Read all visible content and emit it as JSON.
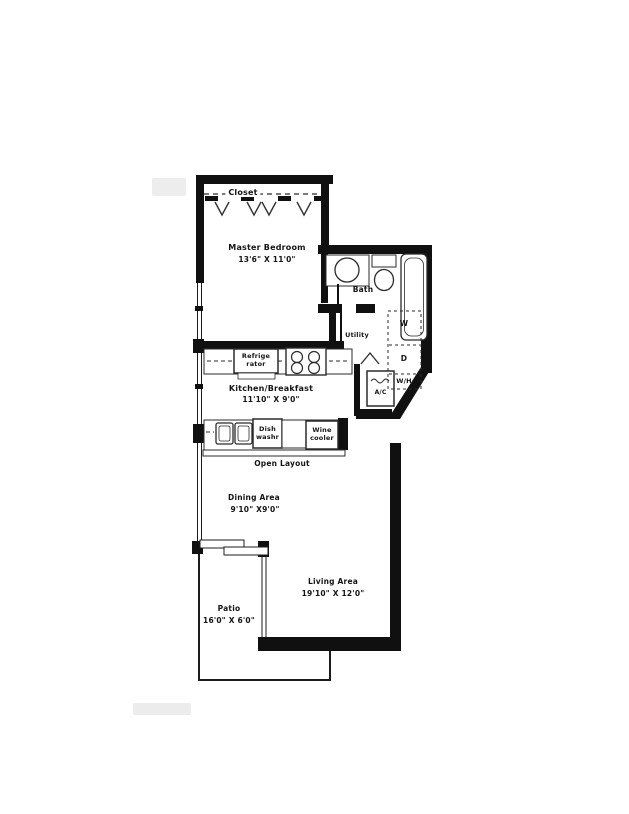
{
  "rooms": {
    "closet": {
      "label": "Closet"
    },
    "master_bedroom": {
      "label": "Master Bedroom",
      "dims": "13'6\" X 11'0\""
    },
    "bath": {
      "label": "Bath"
    },
    "utility": {
      "label": "Utility"
    },
    "kitchen": {
      "label": "Kitchen/Breakfast",
      "dims": "11'10\" X 9'0\""
    },
    "open_layout": {
      "label": "Open Layout"
    },
    "dining": {
      "label": "Dining Area",
      "dims": "9'10\" X9'0\""
    },
    "living": {
      "label": "Living Area",
      "dims": "19'10\" X 12'0\""
    },
    "patio": {
      "label": "Patio",
      "dims": "16'0\" X 6'0\""
    }
  },
  "appliances": {
    "refrigerator": {
      "line1": "Refrige",
      "line2": "rator"
    },
    "dishwasher": {
      "line1": "Dish",
      "line2": "washr"
    },
    "wine_cooler": {
      "line1": "Wine",
      "line2": "cooler"
    },
    "washer": {
      "label": "W"
    },
    "dryer": {
      "label": "D"
    },
    "water_heater": {
      "label": "W/H"
    },
    "air_conditioner": {
      "label": "A/C"
    }
  },
  "colors": {
    "wall": "#101010",
    "line": "#2b2b2b",
    "background": "#ffffff"
  }
}
